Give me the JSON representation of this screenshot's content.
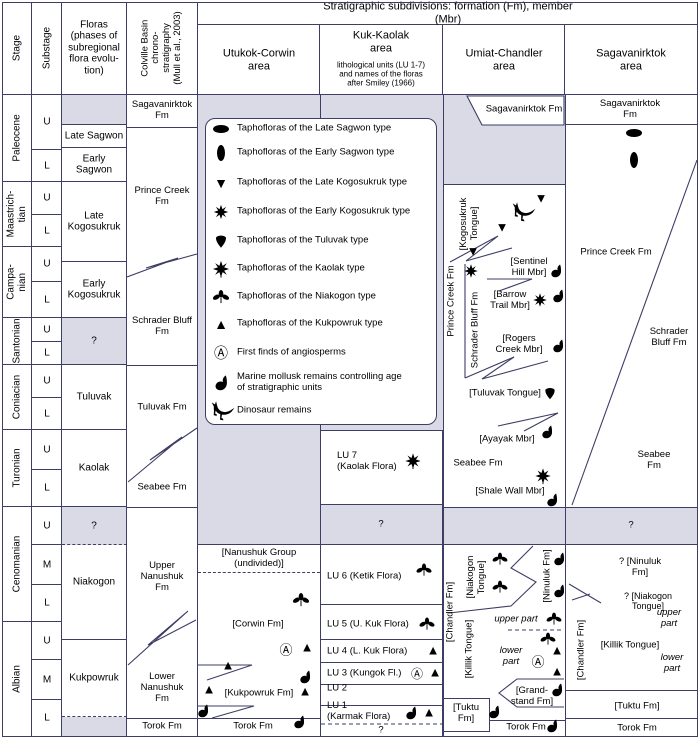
{
  "palette": {
    "shade": "#dadae6",
    "line": "#3d3d66",
    "text": "#000000"
  },
  "header": {
    "strat_title": "Stratigraphic subdivisions: formation (Fm), member (Mbr)",
    "stage": "Stage",
    "substage": "Substage",
    "floras": "Floras\n(phases of\nsubregional\nflora evolu-\ntion)",
    "colville": "Colville Basin\nchrono-\nstratigraphy\n(Mull et al., 2003)",
    "area_utukok": "Utukok-Corwin\narea",
    "area_kuk_title": "Kuk-Kaolak\narea",
    "area_kuk_sub": "lithological units (LU 1-7)\nand names of the floras\nafter Smiley (1966)",
    "area_umiat": "Umiat-Chandler\narea",
    "area_sagav": "Sagavanirktok\narea"
  },
  "stages": [
    {
      "name": "Paleocene",
      "subs": [
        "U",
        "L"
      ]
    },
    {
      "name": "Maastrich-\ntian",
      "subs": [
        "U",
        "L"
      ]
    },
    {
      "name": "Campa-\nnian",
      "subs": [
        "U",
        "L"
      ]
    },
    {
      "name": "Santonian",
      "subs": [
        "U",
        "L"
      ]
    },
    {
      "name": "Coniacian",
      "subs": [
        "U",
        "L"
      ]
    },
    {
      "name": "Turonian",
      "subs": [
        "U",
        "L"
      ]
    },
    {
      "name": "Cenomanian",
      "subs": [
        "U",
        "M",
        "L"
      ]
    },
    {
      "name": "Albian",
      "subs": [
        "U",
        "M",
        "L"
      ]
    }
  ],
  "floras_col": {
    "late_sagwon": "Late Sagwon",
    "early_sagwon": "Early\nSagwon",
    "late_kogosukruk": "Late\nKogosukruk",
    "early_kogosukruk": "Early\nKogosukruk",
    "q1": "?",
    "tuluvak": "Tuluvak",
    "kaolak": "Kaolak",
    "q2": "?",
    "niakogon": "Niakogon",
    "kukpowruk": "Kukpowruk"
  },
  "colville_col": {
    "sagavanirktok": "Sagavanirktok\nFm",
    "prince_creek": "Prince Creek\nFm",
    "schrader_bluff": "Schrader Bluff\nFm",
    "tuluvak": "Tuluvak Fm",
    "seabee": "Seabee Fm",
    "upper_nanushuk": "Upper\nNanushuk\nFm",
    "lower_nanushuk": "Lower\nNanushuk\nFm",
    "torok": "Torok Fm"
  },
  "legend": {
    "items": [
      {
        "icon": "late-sagwon-icon",
        "label": "Taphofloras of the Late Sagwon type"
      },
      {
        "icon": "early-sagwon-icon",
        "label": "Taphofloras of the Early Sagwon type"
      },
      {
        "icon": "late-kogosukruk-icon",
        "label": "Taphofloras of the Late Kogosukruk type"
      },
      {
        "icon": "early-kogosukruk-icon",
        "label": "Taphofloras of the Early Kogosukruk type"
      },
      {
        "icon": "tuluvak-icon",
        "label": "Taphofloras of the Tuluvak type"
      },
      {
        "icon": "kaolak-icon",
        "label": "Taphofloras of the Kaolak type"
      },
      {
        "icon": "niakogon-icon",
        "label": "Taphofloras of the Niakogon type"
      },
      {
        "icon": "kukpowruk-icon",
        "label": "Taphofloras of the Kukpowruk type"
      },
      {
        "icon": "angiosperm-icon",
        "label": "First finds of angiosperms"
      },
      {
        "icon": "mollusk-icon",
        "label": "Marine mollusk remains controlling age\nof stratigraphic units"
      },
      {
        "icon": "dinosaur-icon",
        "label": "Dinosaur remains"
      }
    ]
  },
  "utukok": {
    "nanushuk_group": "[Nanushuk Group\n(undivided)]",
    "corwin": "[Corwin Fm]",
    "kukpowruk": "[Kukpowruk Fm]",
    "torok": "Torok Fm"
  },
  "kuk": {
    "lu7": "LU 7\n(Kaolak Flora)",
    "q_mid": "?",
    "lu6": "LU 6 (Ketik Flora)",
    "lu5": "LU 5 (U. Kuk Flora)",
    "lu4": "LU 4 (L. Kuk Flora)",
    "lu3": "LU 3 (Kungok Fl.)",
    "lu2": "LU 2",
    "lu1": "LU 1\n(Karmak Flora)",
    "q_bottom": "?"
  },
  "umiat": {
    "sagavanirktok": "Sagavanirktok Fm",
    "kogosukruk_tongue": "[Kogosukruk\nTongue]",
    "prince_creek": "Prince Creek Fm",
    "schrader_bluff": "Schrader Bluff Fm",
    "sentinel_hill": "[Sentinel\nHill Mbr]",
    "barrow_trail": "[Barrow\nTrail Mbr]",
    "rogers_creek": "[Rogers\nCreek Mbr]",
    "tuluvak_tongue": "[Tuluvak Tongue]",
    "ayayak": "[Ayayak Mbr]",
    "seabee": "Seabee Fm",
    "shale_wall": "[Shale Wall Mbr]",
    "chandler": "[Chandler Fm]",
    "niakogon_tongue": "[Niakogon\nTongue]",
    "ninuluk": "[Ninuluk Fm]",
    "killik": "[Killik Tongue]",
    "upper_part": "upper part",
    "lower_part": "lower\npart",
    "grandstand": "[Grand-\nstand Fm]",
    "tuktu": "[Tuktu\nFm]",
    "torok": "Torok Fm"
  },
  "sagav": {
    "sagavanirktok": "Sagavanirktok Fm",
    "prince_creek": "Prince Creek Fm",
    "schrader_bluff": "Schrader\nBluff Fm",
    "seabee": "Seabee Fm",
    "q": "?",
    "ninuluk": "?  [Ninuluk Fm]",
    "niakogon_tongue": "? [Niakogon Tongue]",
    "upper_part": "upper part",
    "chandler": "[Chandler Fm]",
    "killik": "[Killik Tongue]",
    "lower_part": "lower part",
    "tuktu": "[Tuktu Fm]",
    "torok": "Torok Fm"
  },
  "icons": {
    "angiosperm": "Ⓐ",
    "tri_up": "▲",
    "tri_down": "▼",
    "late_sagwon": "black horizontal ellipse",
    "early_sagwon": "black vertical ellipse",
    "late_kogosukruk": "black down triangle",
    "early_kogosukruk": "spiky leaf star",
    "kaolak": "spiky leaf star with stem",
    "tuluvak": "inverted shield leaf",
    "niakogon": "trefoil leaf",
    "mollusk": "comma shell",
    "dinosaur": "theropod silhouette"
  }
}
